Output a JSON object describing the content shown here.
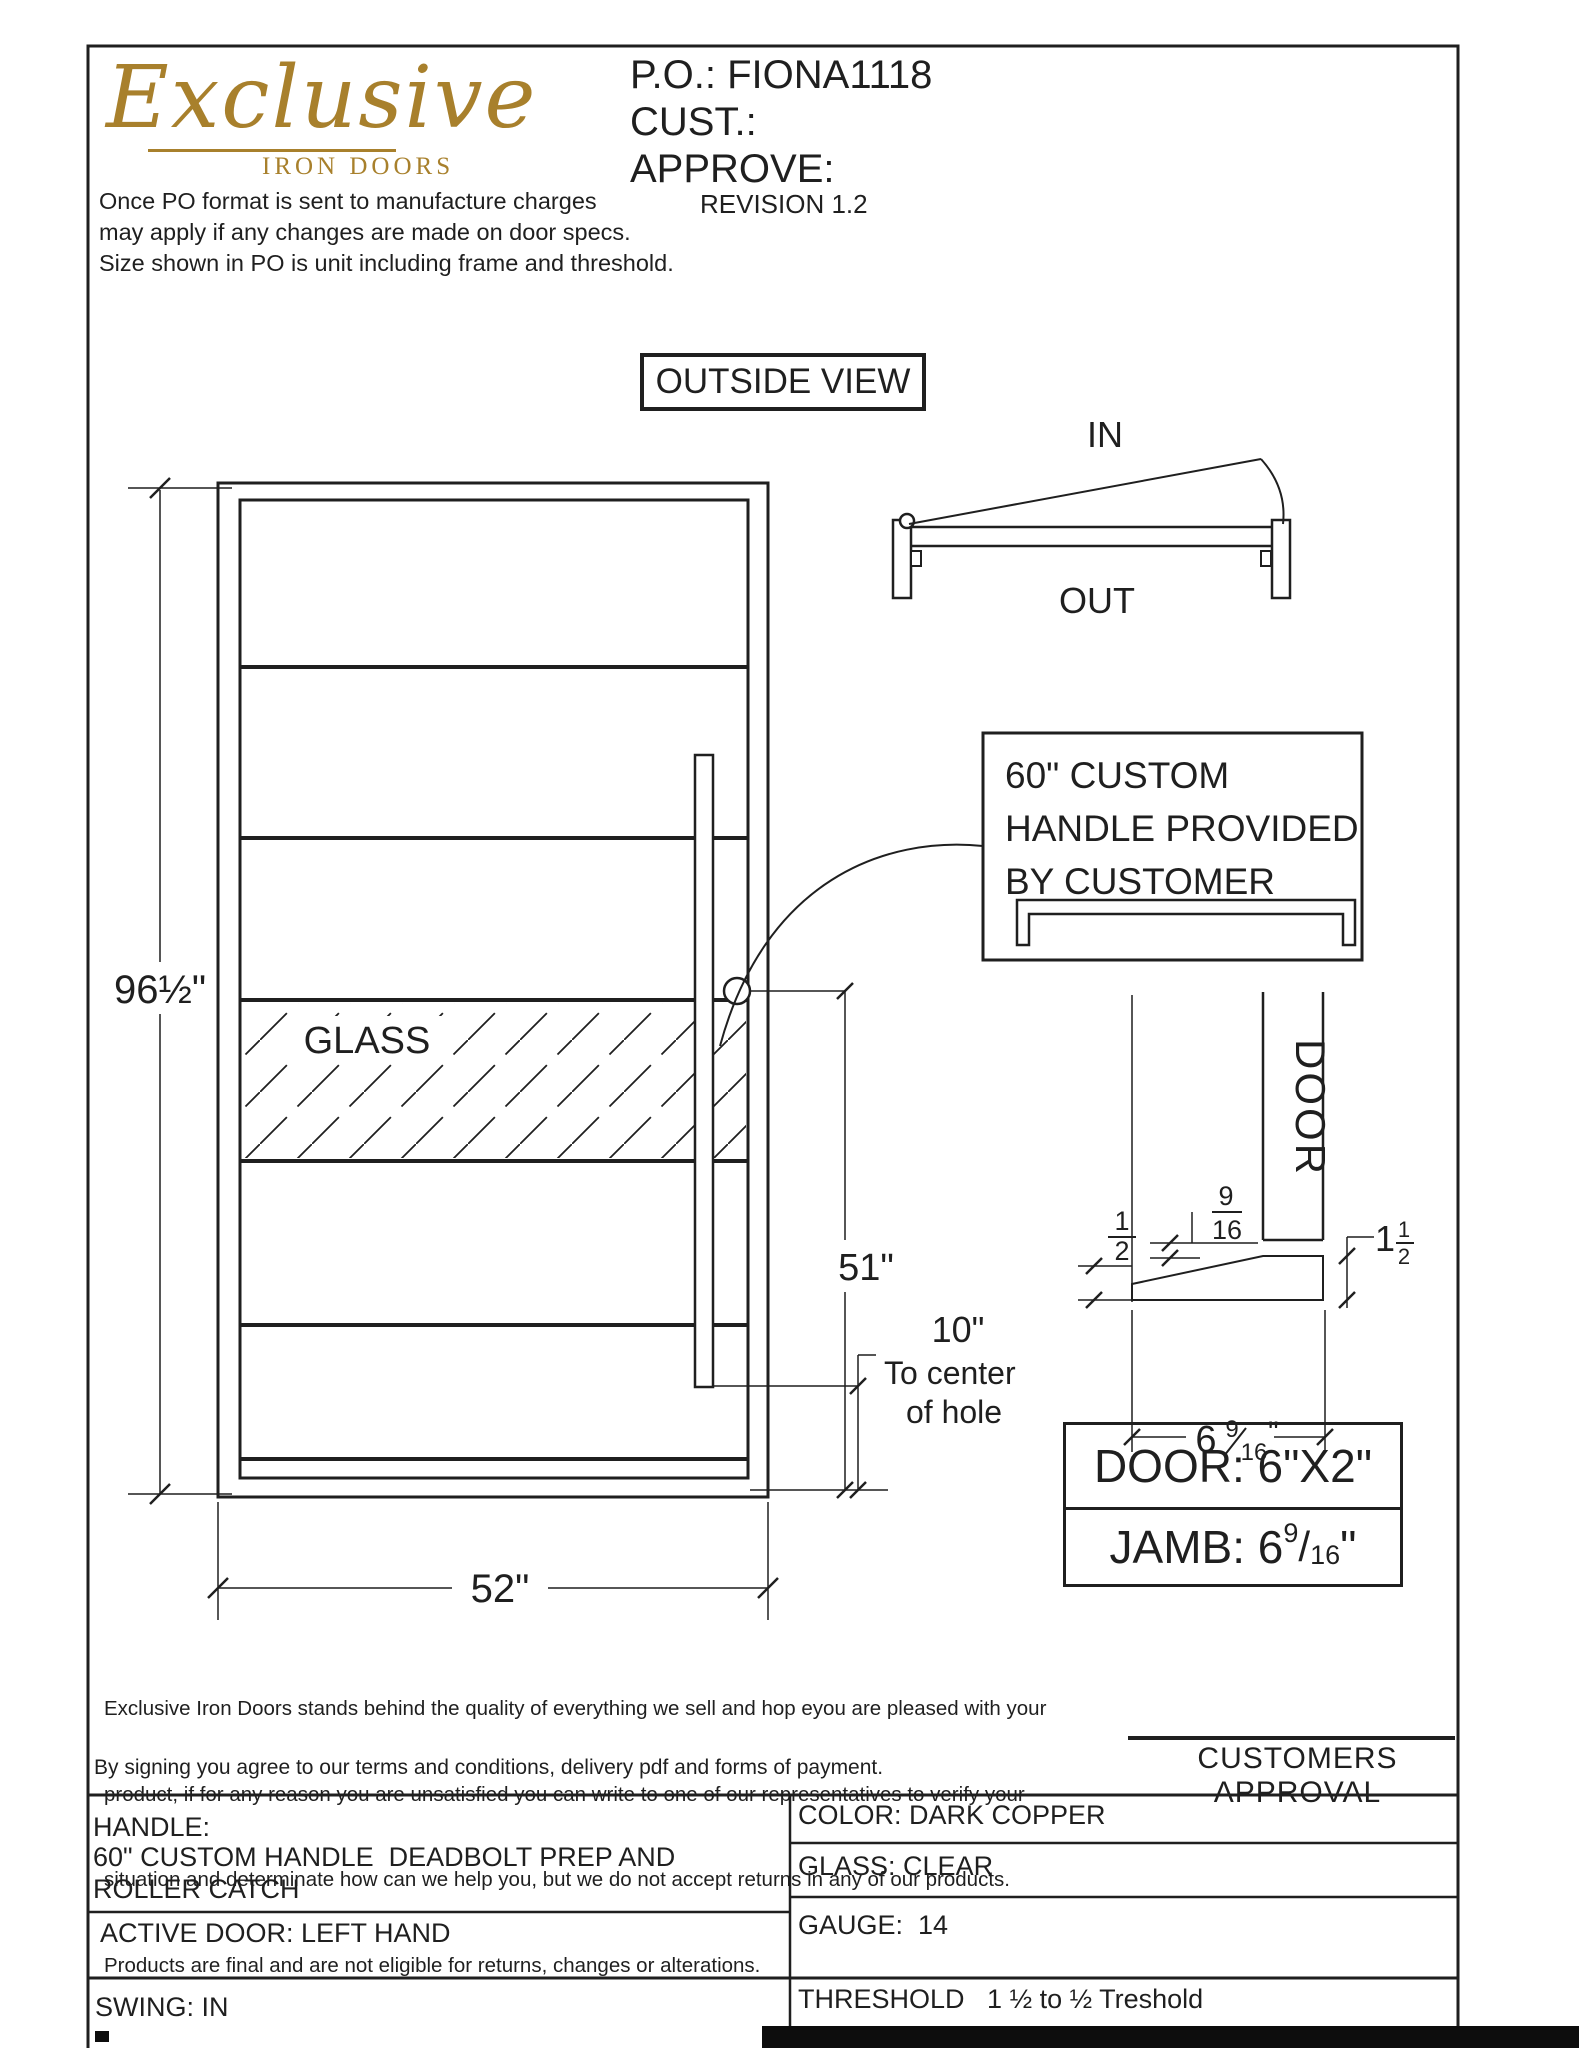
{
  "colors": {
    "ink": "#1f1f1f",
    "gold": "#a8802c",
    "paper": "#ffffff"
  },
  "header": {
    "logo_script": "Exclusive",
    "logo_sub": "IRON DOORS",
    "po": "P.O.: FIONA1118",
    "cust": "CUST.:",
    "approve": "APPROVE:",
    "revision": "REVISION 1.2",
    "notice_line1": "Once PO format is sent to manufacture charges",
    "notice_line2": "may apply if any changes are made on door specs.",
    "notice_line3": "Size shown in PO is unit including frame and threshold."
  },
  "drawing": {
    "view_label": "OUTSIDE VIEW",
    "swing_in": "IN",
    "swing_out": "OUT",
    "glass_label": "GLASS",
    "dim_height": "96½\"",
    "dim_width": "52\"",
    "dim_51": "51\"",
    "dim_10": "10\"",
    "hole_note_line1": "To center",
    "hole_note_line2": "of hole",
    "callout_line1": "60\" CUSTOM",
    "callout_line2": "HANDLE PROVIDED",
    "callout_line3": "BY CUSTOMER",
    "detail_door_label": "DOOR",
    "frac916_num": "9",
    "frac916_den": "16",
    "frac12_num": "1",
    "frac12_den": "2",
    "dim_1half_whole": "1",
    "dim_1half_num": "1",
    "dim_1half_den": "2",
    "dim_jamb_whole": "6",
    "dim_jamb_num": "9",
    "dim_jamb_den": "16",
    "dim_jamb_unit": "\"",
    "door_size_box": "DOOR: 6\"X2\"",
    "jamb_box_prefix": "JAMB: 6",
    "jamb_box_num": "9",
    "jamb_box_slash": "/",
    "jamb_box_den": "16",
    "jamb_box_unit": "\""
  },
  "footer": {
    "disclaimer_line1": "Exclusive Iron Doors stands behind the quality of everything we sell and hop eyou are pleased with your",
    "disclaimer_line2": "product, if for any reason you are unsatisfied you can write to one of our representatives to verify your",
    "disclaimer_line3": "situation and determinate how can we help you, but we do not accept returns in any of our products.",
    "disclaimer_line4": "Products are final and are not eligible for returns, changes or alterations.",
    "signing_note": "By signing you agree to our terms and conditions, delivery pdf and forms of payment.",
    "approval_label": "CUSTOMERS APPROVAL",
    "table": {
      "handle_label": "HANDLE:",
      "handle_value_line1": "60\" CUSTOM HANDLE  DEADBOLT PREP AND",
      "handle_value_line2": "ROLLER CATCH",
      "active_door": "ACTIVE DOOR: LEFT HAND",
      "swing": "SWING: IN",
      "color": "COLOR: DARK COPPER",
      "glass": "GLASS: CLEAR",
      "gauge": "GAUGE:  14",
      "threshold_label": "THRESHOLD",
      "threshold_value": "1 ½ to ½ Treshold"
    }
  }
}
